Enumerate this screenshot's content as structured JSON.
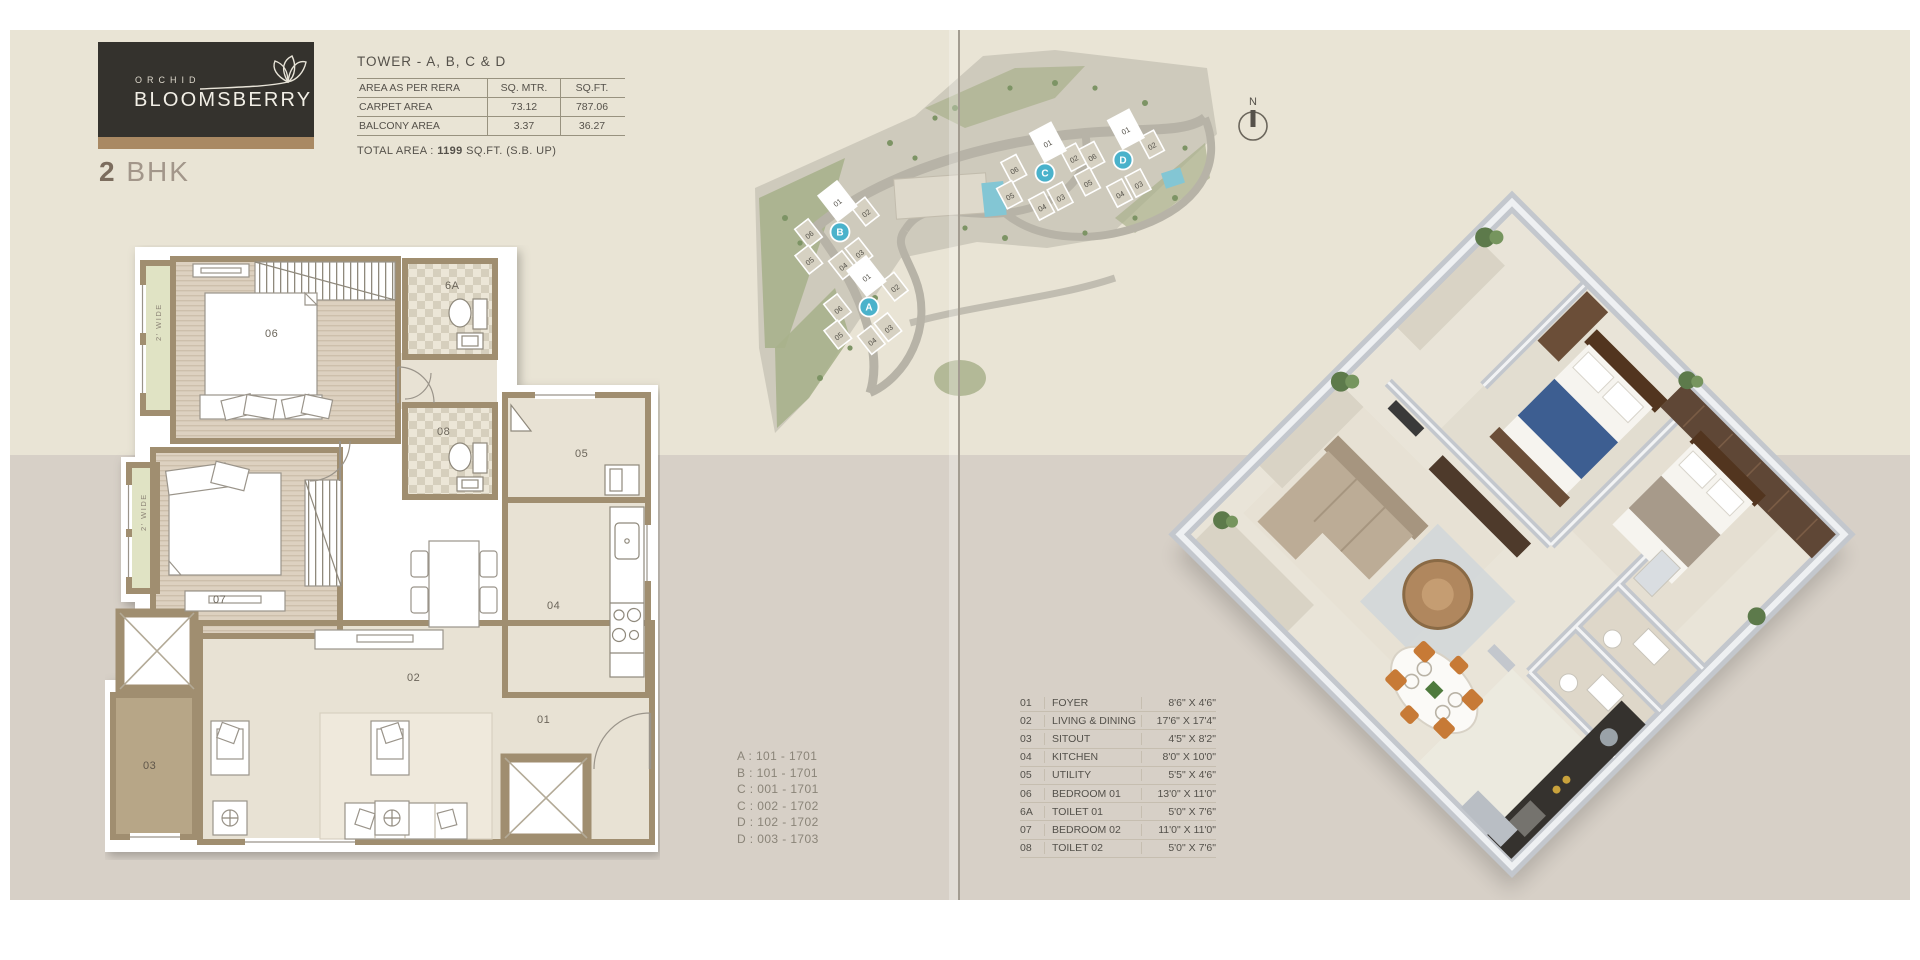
{
  "brand": {
    "name_top": "ORCHID",
    "name_bottom": "BLOOMSBERRY",
    "unit_number": "2",
    "unit_label": "BHK"
  },
  "area_table": {
    "title": "TOWER - A, B, C & D",
    "header": {
      "label": "AREA AS PER RERA",
      "col1": "SQ. MTR.",
      "col2": "SQ.FT."
    },
    "rows": [
      {
        "label": "CARPET AREA",
        "sq_mtr": "73.12",
        "sq_ft": "787.06"
      },
      {
        "label": "BALCONY AREA",
        "sq_mtr": "3.37",
        "sq_ft": "36.27"
      }
    ],
    "total_prefix": "TOTAL AREA : ",
    "total_value": "1199",
    "total_suffix": " SQ.FT. (S.B. UP)"
  },
  "floorplan": {
    "labels": {
      "bed1": "06",
      "toilet1": "6A",
      "toilet2": "08",
      "bed2": "07",
      "utility": "05",
      "kitchen": "04",
      "living": "02",
      "sitout": "03",
      "foyer": "01",
      "balcony1": "2' WIDE",
      "balcony2": "2' WIDE"
    }
  },
  "sitemap": {
    "towers": [
      {
        "letter": "A"
      },
      {
        "letter": "B"
      },
      {
        "letter": "C"
      },
      {
        "letter": "D"
      }
    ],
    "unit_labels": [
      "01",
      "02",
      "03",
      "04",
      "05",
      "06"
    ],
    "north_label": "N"
  },
  "units_list": [
    "A : 101 - 1701",
    "B : 101 - 1701",
    "C : 001 - 1701",
    "C : 002 - 1702",
    "D : 102 - 1702",
    "D : 003 - 1703"
  ],
  "legend": {
    "rows": [
      {
        "num": "01",
        "name": "FOYER",
        "dims": "8'6\" X 4'6\""
      },
      {
        "num": "02",
        "name": "LIVING & DINING",
        "dims": "17'6\" X 17'4\""
      },
      {
        "num": "03",
        "name": "SITOUT",
        "dims": "4'5\" X 8'2\""
      },
      {
        "num": "04",
        "name": "KITCHEN",
        "dims": "8'0\" X 10'0\""
      },
      {
        "num": "05",
        "name": "UTILITY",
        "dims": "5'5\" X 4'6\""
      },
      {
        "num": "06",
        "name": "BEDROOM 01",
        "dims": "13'0\" X 11'0\""
      },
      {
        "num": "6A",
        "name": "TOILET 01",
        "dims": "5'0\" X 7'6\""
      },
      {
        "num": "07",
        "name": "BEDROOM 02",
        "dims": "11'0\" X 11'0\""
      },
      {
        "num": "08",
        "name": "TOILET 02",
        "dims": "5'0\" X 7'6\""
      }
    ]
  },
  "colors": {
    "logo_bg": "#34322d",
    "logo_strip": "#a98963",
    "band_top": "#e9e4d5",
    "band_bottom": "#d7d0c7",
    "badge_teal": "#4ab2cb",
    "wall_tan": "#a08e70",
    "balcony_green": "#e0e3c4",
    "sitout_brown": "#b7a687",
    "text_dark": "#55514a",
    "text_muted": "#8a8478"
  }
}
